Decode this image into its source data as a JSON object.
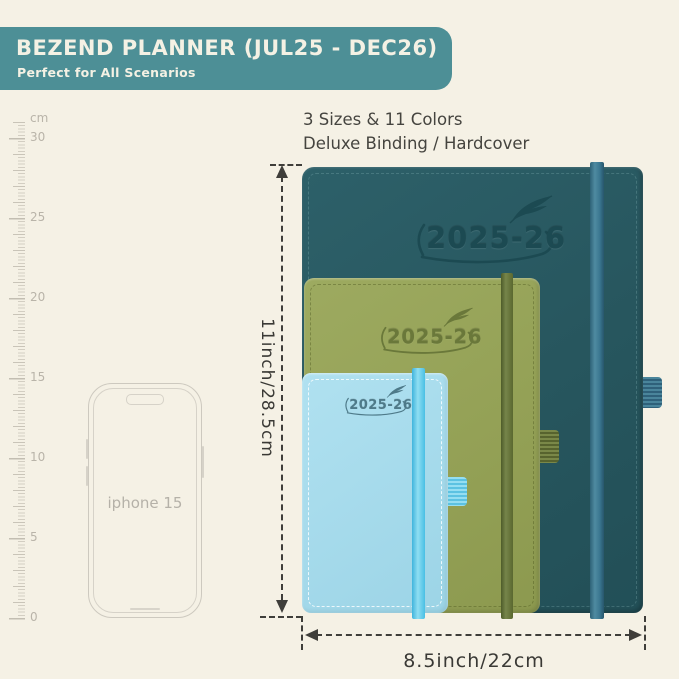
{
  "banner": {
    "title": "BEZEND PLANNER (JUL25 - DEC26)",
    "subtitle": "Perfect for All Scenarios",
    "bg_color": "#4d8f96",
    "text_color": "#f4f1e4"
  },
  "info": {
    "line1": "3 Sizes & 11 Colors",
    "line2": "Deluxe Binding / Hardcover"
  },
  "ruler": {
    "unit": "cm",
    "labels": [
      "30",
      "25",
      "20",
      "15",
      "10",
      "5",
      "0"
    ]
  },
  "phone": {
    "label": "iphone 15"
  },
  "planners": [
    {
      "name": "large",
      "year": "2025-26",
      "cover_color": "#27565e",
      "elastic_color": "#41809a"
    },
    {
      "name": "medium",
      "year": "2025-26",
      "cover_color": "#94a156",
      "elastic_color": "#5e6d33"
    },
    {
      "name": "small",
      "year": "2025-26",
      "cover_color": "#a5daeb",
      "elastic_color": "#4fc5e9"
    }
  ],
  "dimensions": {
    "height_label": "11inch/28.5cm",
    "width_label": "8.5inch/22cm"
  },
  "colors": {
    "background": "#f5f1e5",
    "annotation": "#3f3e3a",
    "ruler": "#c9c4b8",
    "phone_outline": "#cdc9bf"
  }
}
